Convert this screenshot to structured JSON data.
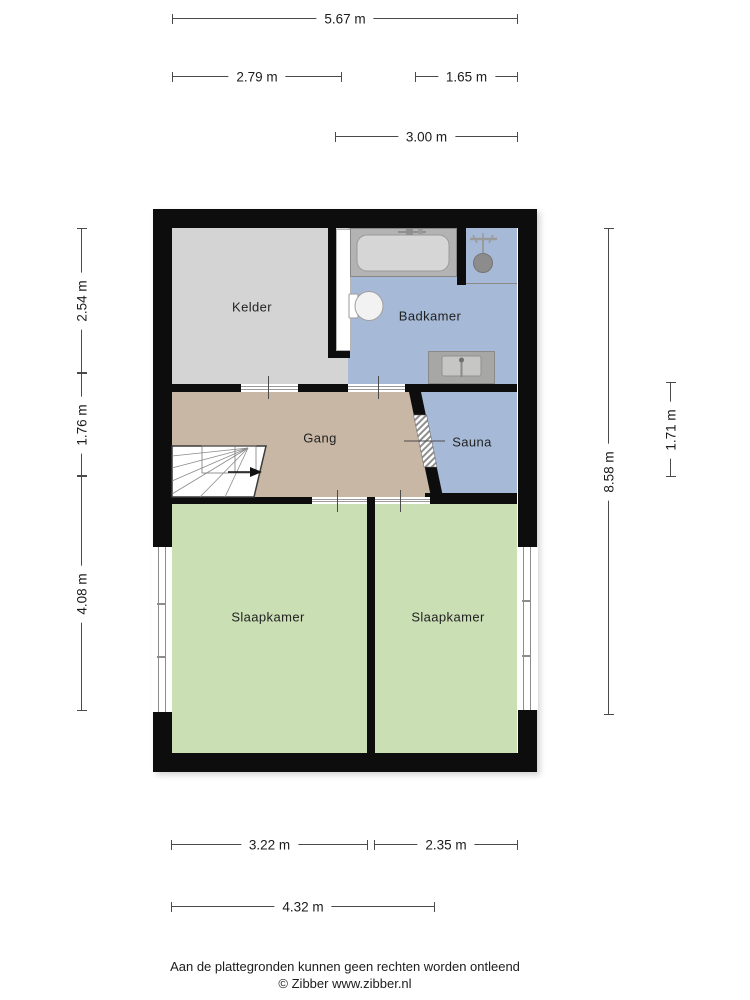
{
  "floorplan": {
    "rooms": [
      {
        "id": "kelder",
        "label": "Kelder"
      },
      {
        "id": "badkamer",
        "label": "Badkamer"
      },
      {
        "id": "gang",
        "label": "Gang"
      },
      {
        "id": "sauna",
        "label": "Sauna"
      },
      {
        "id": "slaapkamer-left",
        "label": "Slaapkamer"
      },
      {
        "id": "slaapkamer-right",
        "label": "Slaapkamer"
      }
    ],
    "dimensions": {
      "top_full": "5.67 m",
      "top_left": "2.79 m",
      "top_right": "1.65 m",
      "top_inner": "3.00 m",
      "left_upper": "2.54 m",
      "left_middle": "1.76 m",
      "left_lower": "4.08 m",
      "right_full": "8.58 m",
      "right_inner": "1.71 m",
      "bottom_left": "3.22 m",
      "bottom_right": "2.35 m",
      "bottom_inner": "4.32 m"
    },
    "fixtures": [
      "bathtub-icon",
      "shower-icon",
      "toilet-icon",
      "sink-icon",
      "stairs-icon",
      "door-threshold-icon",
      "window-icon",
      "sauna-door-hatch-icon"
    ],
    "colors": {
      "wall": "#0d0d0d",
      "kelder": "#d4d4d4",
      "badkamer": "#a6bad7",
      "sauna": "#a6bad7",
      "gang": "#c9b7a5",
      "slaapkamer": "#cbdfb5"
    },
    "footer": {
      "disclaimer": "Aan de plattegronden kunnen geen rechten worden ontleend",
      "copyright": "© Zibber www.zibber.nl"
    }
  }
}
